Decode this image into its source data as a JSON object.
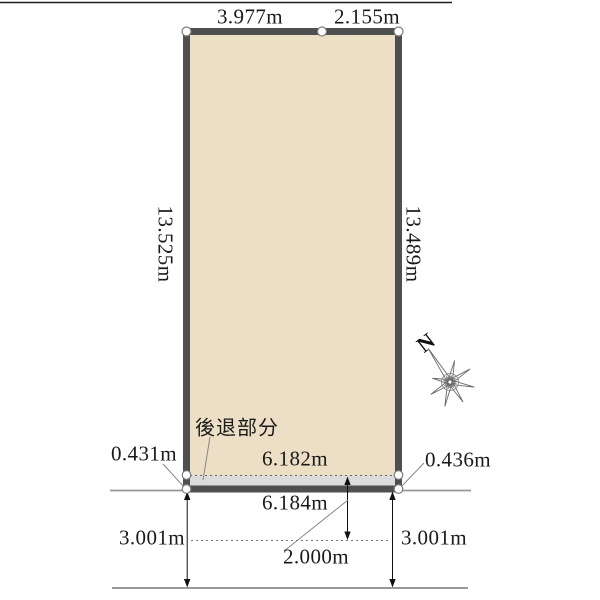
{
  "plot": {
    "fill": "#ecdfc6",
    "boundary_color": "#4f4f4f",
    "top_edges": [
      {
        "label": "3.977m"
      },
      {
        "label": "2.155m"
      }
    ],
    "left_edge_label": "13.525m",
    "right_edge_label": "13.489m"
  },
  "setback": {
    "label": "後退部分",
    "fill": "#dcdcdc",
    "left_depth": "0.431m",
    "line_length": "6.182m",
    "right_depth": "0.436m"
  },
  "road": {
    "frontage": "6.184m",
    "width_left": "3.001m",
    "width_right": "3.001m",
    "center_setback": "2.000m"
  },
  "compass": {
    "north_label": "N"
  }
}
